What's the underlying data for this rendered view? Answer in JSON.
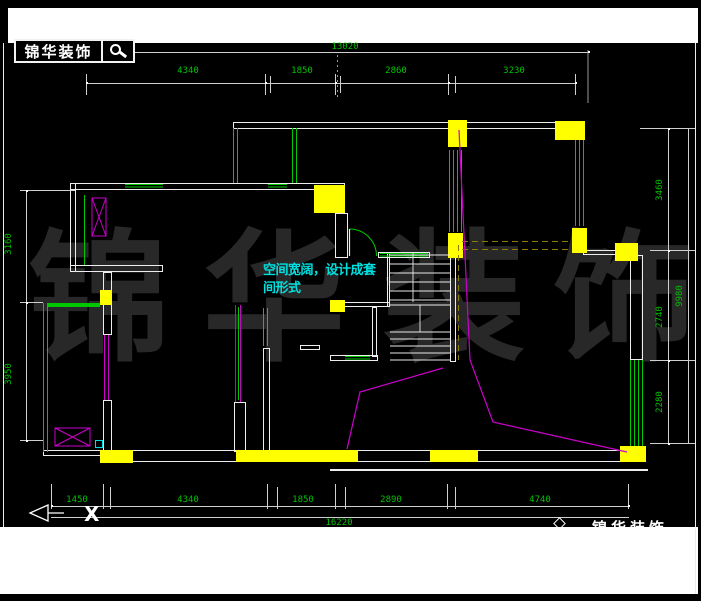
{
  "header": {
    "logo_text": "锦华装饰",
    "search_icon": "magnifier"
  },
  "footer": {
    "logo_text": "锦华装饰",
    "logo_icon": "diamond-house"
  },
  "annotation": {
    "line1": "空间宽阔，设计成套",
    "line2": "间形式"
  },
  "watermark": {
    "chars": [
      "锦",
      "华",
      "装",
      "饰"
    ]
  },
  "ucs": {
    "x_label": "X"
  },
  "dims": {
    "top_total": "13020",
    "top": [
      "4340",
      "1850",
      "2860",
      "3230"
    ],
    "bottom": [
      "1450",
      "4340",
      "1850",
      "2890",
      "4740"
    ],
    "bottom_total": "16220",
    "left": [
      "3160",
      "3950"
    ],
    "right": [
      "3460",
      "2740",
      "2280"
    ],
    "right_total": "9980"
  },
  "colors": {
    "dim_text": "#00c200",
    "window": "#00c800",
    "column": "#ffff00",
    "sliding_door": "#cc00cc",
    "annotation": "#00e0e0",
    "wall": "#ededed"
  }
}
